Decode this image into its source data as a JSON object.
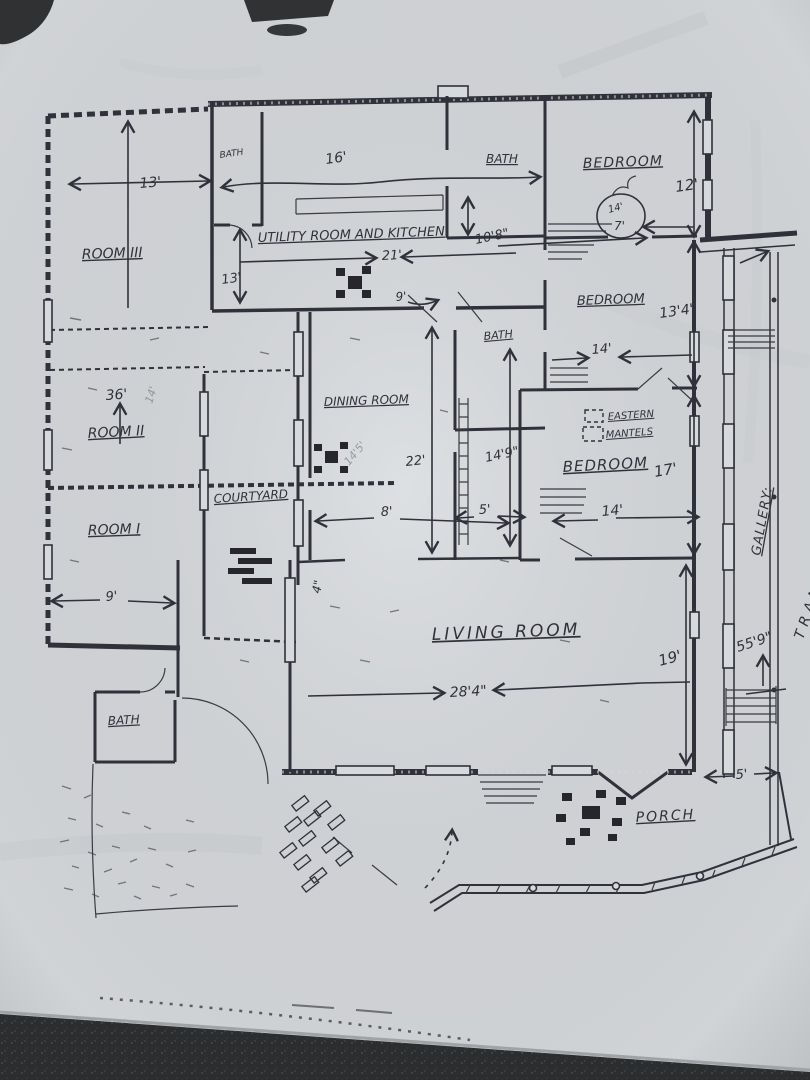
{
  "photo": {
    "paper_color": "#d7dadd",
    "ink_color": "#30313a",
    "pencil_color": "#83868d",
    "table_surface_color": "#2b2d2e"
  },
  "labels": {
    "room_iii": "ROOM III",
    "room_ii": "ROOM II",
    "room_i": "ROOM I",
    "bath_nw": "BATH",
    "bath_top": "BATH",
    "bath_mid": "BATH",
    "bath_sw": "BATH",
    "bedroom_ne": "BEDROOM",
    "bedroom_e": "BEDROOM",
    "bedroom_se": "BEDROOM",
    "utility": "UTILITY ROOM AND KITCHEN",
    "dining": "DINING ROOM",
    "living": "LIVING ROOM",
    "courtyard": "COURTYARD",
    "porch": "PORCH",
    "gallery": "GALLERY:",
    "transfer_gate": "TRANSFER GATE",
    "mantels_1": "EASTERN",
    "mantels_2": "MANTELS"
  },
  "dimensions": {
    "room_iii_width": "13'",
    "hall_13": "13'",
    "left_wing_36": "36'",
    "room_i_width": "9'",
    "kitchen_16": "16'",
    "kitchen_21": "21'",
    "kitchen_10_8": "10'8\"",
    "bedroom_ne_12": "12'",
    "closet_14": "14'",
    "closet_7": "7'",
    "bedroom_e_13_4": "13'4\"",
    "bedroom_e_14": "14'",
    "dining_22": "22'",
    "hall_14_9": "14'9\"",
    "hall_9": "9'",
    "bedroom_se_17": "17'",
    "bedroom_se_14": "14'",
    "courtyard_8": "8'",
    "courtyard_5": "5'",
    "wall_4": "4\"",
    "living_28_4": "28'4\"",
    "living_19": "19'",
    "total_55_9": "55'9\"",
    "porch_5": "5'",
    "pencil_14_5": "14'5'",
    "room_ii_pencil": "14'"
  }
}
